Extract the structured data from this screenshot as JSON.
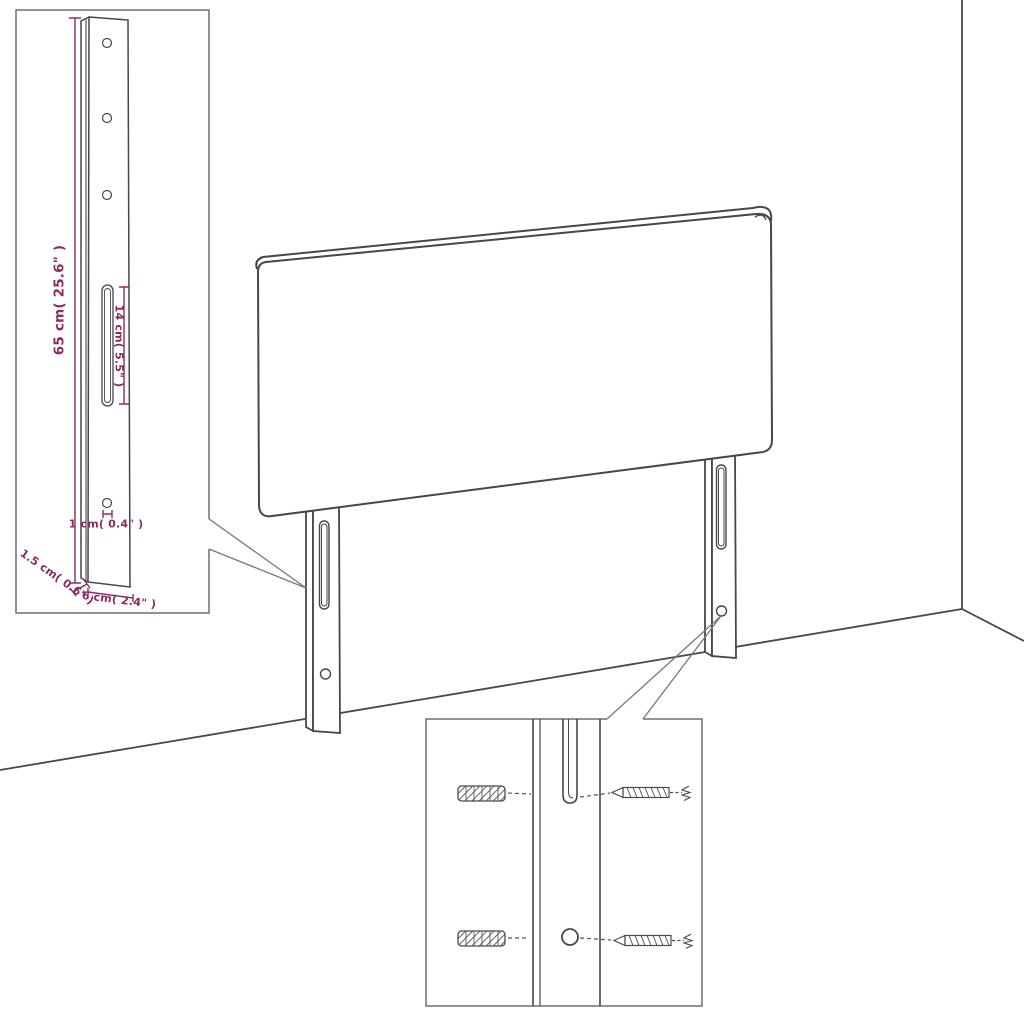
{
  "diagram": {
    "type": "assembly-dimension-diagram",
    "colors": {
      "dimension_accent": "#8b2a63",
      "line_art": "#474747",
      "inset_border": "#6f6f6f",
      "background": "#ffffff"
    },
    "leg_detail_inset": {
      "labels": {
        "leg_height": "65 cm( 25.6\" )",
        "slot_length": "14 cm( 5.5\" )",
        "hole_diameter": "1 cm( 0.4\" )",
        "leg_thickness": "1.5 cm( 0.6\" )",
        "leg_width": "6 cm( 2.4\" )"
      }
    }
  }
}
